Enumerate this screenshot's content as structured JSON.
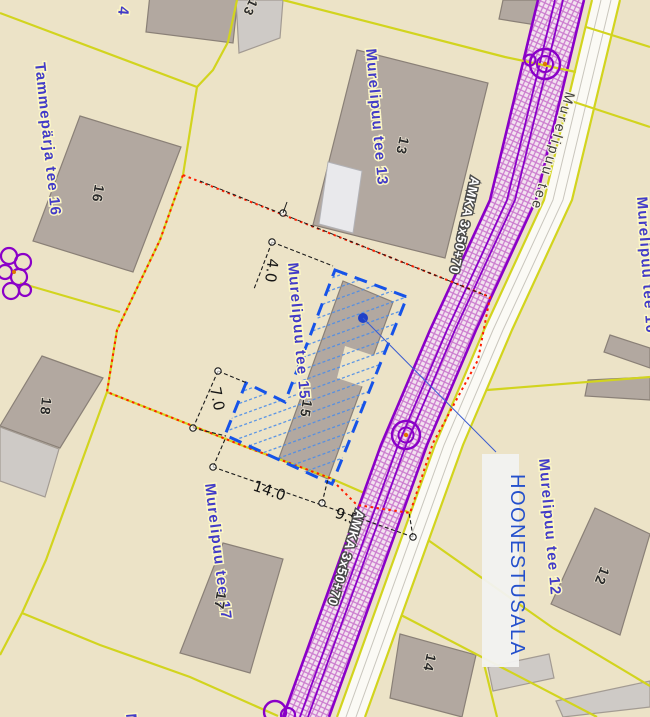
{
  "colors": {
    "parcel_fill": "#ece3c7",
    "parcel_line_yellow": "#d2d41e",
    "building_gray": "#b2a8a0",
    "road_corridor_purple": "#8a00c8",
    "road_strip_white": "#fbfaf5",
    "planning_boundary_red": "#ff1e00",
    "hoonestusala_blue": "#1653e8",
    "hatch_blue": "#4d8de8",
    "label_blue": "#423bc8",
    "label_halo": "#fcf7c6",
    "annotation_blue": "#2450cc"
  },
  "road": {
    "street_name": "Murelipuu tee",
    "cable_label": "AMKA 3x50+70"
  },
  "annotation": {
    "label": "HOONESTUSALA"
  },
  "dimensions": {
    "d1": "4.0",
    "d2": "7.0",
    "d3": "14.0",
    "d4": "9.5"
  },
  "addresses": {
    "tammeparja_16": "Tammepärja tee 16",
    "murelipuu_13": "Murelipuu tee 13",
    "murelipuu_15": "Murelipuu tee 15",
    "murelipuu_17": "Murelipuu tee 17",
    "murelipuu_10": "Murelipuu tee 10",
    "murelipuu_12": "Murelipuu tee 12",
    "partial_top": "4",
    "partial_bottom": "M"
  },
  "building_numbers": {
    "b16": "16",
    "b13": "13",
    "b13_top": "13",
    "b18": "18",
    "b15": "15",
    "b17": "17",
    "b12": "12",
    "b14": "14"
  }
}
